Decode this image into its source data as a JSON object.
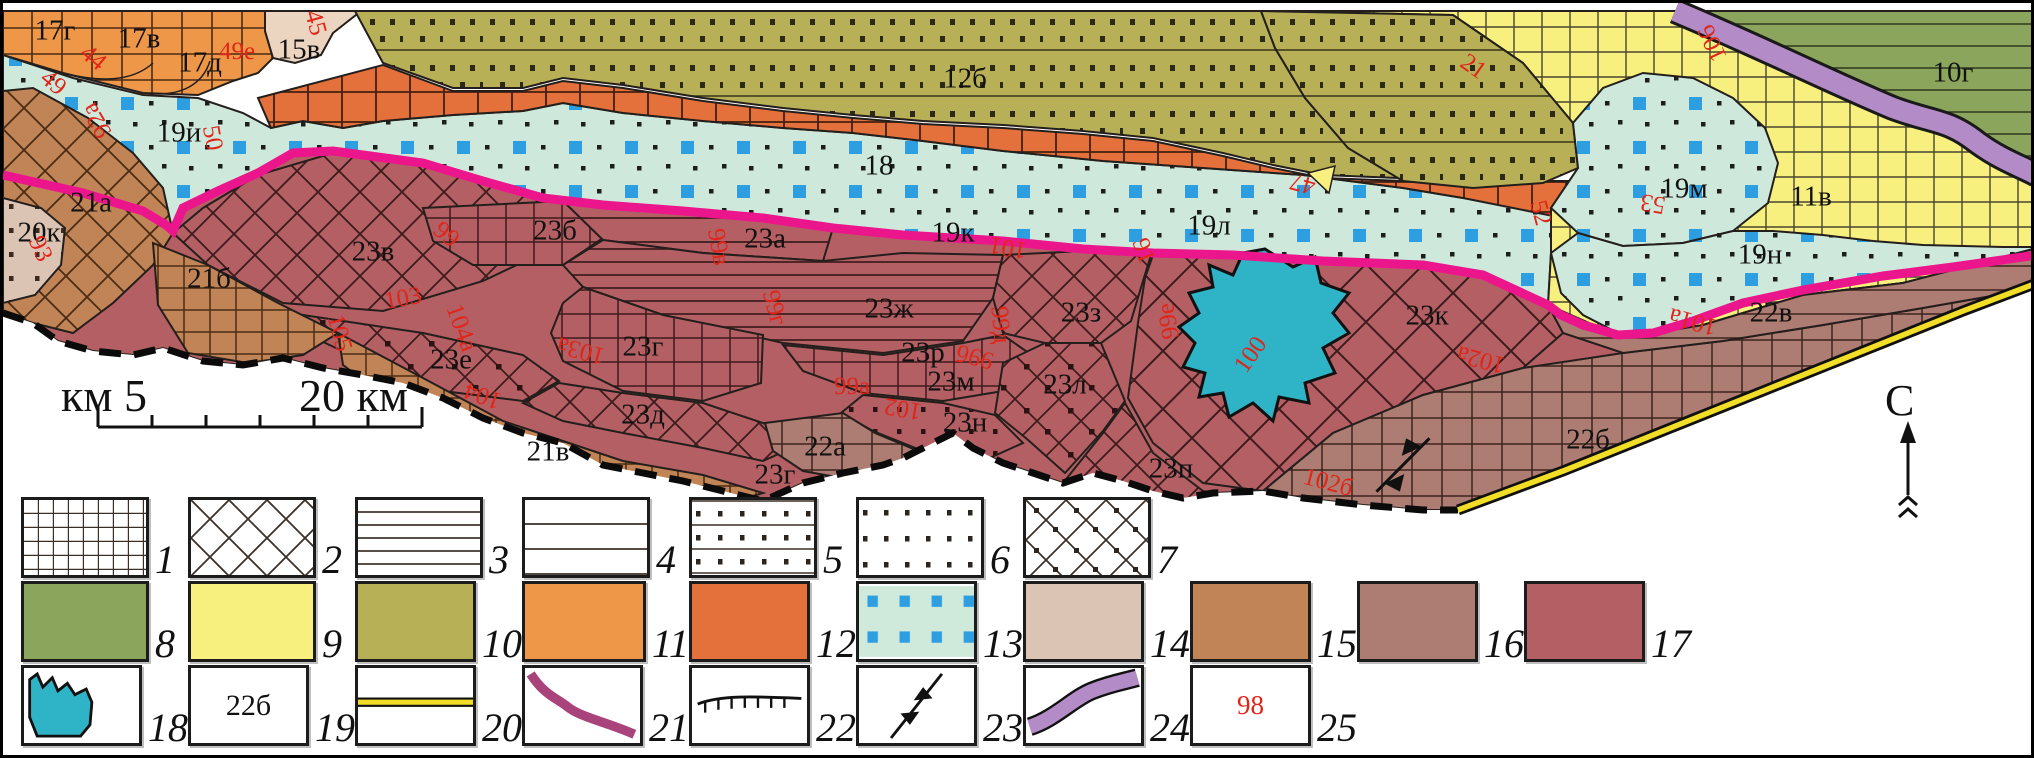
{
  "map": {
    "north_label": "С",
    "scale": {
      "left": "км 5",
      "right": "20 км"
    },
    "region_labels": [
      {
        "text": "17г",
        "x": 52,
        "y": 28
      },
      {
        "text": "17в",
        "x": 136,
        "y": 36
      },
      {
        "text": "17д",
        "x": 197,
        "y": 60
      },
      {
        "text": "15в",
        "x": 296,
        "y": 47
      },
      {
        "text": "19и",
        "x": 176,
        "y": 130
      },
      {
        "text": "21а",
        "x": 88,
        "y": 200
      },
      {
        "text": "20к",
        "x": 36,
        "y": 230
      },
      {
        "text": "21б",
        "x": 206,
        "y": 276
      },
      {
        "text": "23в",
        "x": 370,
        "y": 249
      },
      {
        "text": "23б",
        "x": 552,
        "y": 228
      },
      {
        "text": "23а",
        "x": 762,
        "y": 236
      },
      {
        "text": "18",
        "x": 876,
        "y": 163
      },
      {
        "text": "12б",
        "x": 962,
        "y": 76
      },
      {
        "text": "19к",
        "x": 950,
        "y": 230
      },
      {
        "text": "19л",
        "x": 1206,
        "y": 223
      },
      {
        "text": "19м",
        "x": 1681,
        "y": 186
      },
      {
        "text": "11в",
        "x": 1808,
        "y": 194
      },
      {
        "text": "10г",
        "x": 1950,
        "y": 70
      },
      {
        "text": "19н",
        "x": 1757,
        "y": 252
      },
      {
        "text": "23ж",
        "x": 886,
        "y": 306
      },
      {
        "text": "23з",
        "x": 1078,
        "y": 310
      },
      {
        "text": "23к",
        "x": 1424,
        "y": 313
      },
      {
        "text": "23г",
        "x": 640,
        "y": 344
      },
      {
        "text": "23е",
        "x": 448,
        "y": 357
      },
      {
        "text": "23д",
        "x": 640,
        "y": 412
      },
      {
        "text": "21в",
        "x": 545,
        "y": 449
      },
      {
        "text": "22а",
        "x": 822,
        "y": 444
      },
      {
        "text": "23н",
        "x": 962,
        "y": 420
      },
      {
        "text": "23м",
        "x": 948,
        "y": 379
      },
      {
        "text": "23л",
        "x": 1062,
        "y": 382
      },
      {
        "text": "23п",
        "x": 1168,
        "y": 466
      },
      {
        "text": "23р",
        "x": 920,
        "y": 350
      },
      {
        "text": "23г",
        "x": 772,
        "y": 472
      },
      {
        "text": "22б",
        "x": 1585,
        "y": 437
      },
      {
        "text": "22в",
        "x": 1768,
        "y": 310
      }
    ],
    "red_labels": [
      {
        "text": "44",
        "x": 90,
        "y": 55,
        "rot": 40
      },
      {
        "text": "49",
        "x": 50,
        "y": 80,
        "rot": 40
      },
      {
        "text": "49е",
        "x": 234,
        "y": 49,
        "rot": 0
      },
      {
        "text": "45",
        "x": 312,
        "y": 20,
        "rot": 75
      },
      {
        "text": "92а",
        "x": 94,
        "y": 117,
        "rot": 240
      },
      {
        "text": "50",
        "x": 209,
        "y": 135,
        "rot": 80
      },
      {
        "text": "93",
        "x": 37,
        "y": 246,
        "rot": 65
      },
      {
        "text": "105",
        "x": 336,
        "y": 330,
        "rot": 75
      },
      {
        "text": "103",
        "x": 400,
        "y": 296,
        "rot": -10
      },
      {
        "text": "104а",
        "x": 458,
        "y": 325,
        "rot": 70
      },
      {
        "text": "103а",
        "x": 578,
        "y": 347,
        "rot": 195
      },
      {
        "text": "104",
        "x": 480,
        "y": 392,
        "rot": 200
      },
      {
        "text": "99",
        "x": 443,
        "y": 232,
        "rot": 40
      },
      {
        "text": "99в",
        "x": 715,
        "y": 244,
        "rot": 80
      },
      {
        "text": "99г",
        "x": 771,
        "y": 305,
        "rot": 75
      },
      {
        "text": "99а",
        "x": 849,
        "y": 384,
        "rot": 0
      },
      {
        "text": "99б",
        "x": 972,
        "y": 353,
        "rot": 195
      },
      {
        "text": "99д",
        "x": 997,
        "y": 322,
        "rot": 85
      },
      {
        "text": "99е",
        "x": 1166,
        "y": 318,
        "rot": 260
      },
      {
        "text": "100",
        "x": 1248,
        "y": 352,
        "rot": -55
      },
      {
        "text": "101",
        "x": 1005,
        "y": 244,
        "rot": 190
      },
      {
        "text": "91",
        "x": 1140,
        "y": 248,
        "rot": 70
      },
      {
        "text": "102",
        "x": 900,
        "y": 405,
        "rot": 190
      },
      {
        "text": "102а",
        "x": 1478,
        "y": 356,
        "rot": 195
      },
      {
        "text": "102б",
        "x": 1325,
        "y": 480,
        "rot": 15
      },
      {
        "text": "101а",
        "x": 1690,
        "y": 318,
        "rot": 195
      },
      {
        "text": "47",
        "x": 1300,
        "y": 180,
        "rot": 195
      },
      {
        "text": "21",
        "x": 1470,
        "y": 64,
        "rot": 35
      },
      {
        "text": "106",
        "x": 1710,
        "y": 40,
        "rot": 245
      },
      {
        "text": "53",
        "x": 1650,
        "y": 200,
        "rot": 190
      },
      {
        "text": "52",
        "x": 1537,
        "y": 210,
        "rot": 75
      }
    ]
  },
  "legend": {
    "items": [
      {
        "num": "1"
      },
      {
        "num": "2"
      },
      {
        "num": "3"
      },
      {
        "num": "4"
      },
      {
        "num": "5"
      },
      {
        "num": "6"
      },
      {
        "num": "7"
      },
      {
        "num": "8"
      },
      {
        "num": "9"
      },
      {
        "num": "10"
      },
      {
        "num": "11"
      },
      {
        "num": "12"
      },
      {
        "num": "13"
      },
      {
        "num": "14"
      },
      {
        "num": "15"
      },
      {
        "num": "16"
      },
      {
        "num": "17"
      },
      {
        "num": "18"
      },
      {
        "num": "19",
        "sample_text": "22б"
      },
      {
        "num": "20"
      },
      {
        "num": "21"
      },
      {
        "num": "22"
      },
      {
        "num": "23"
      },
      {
        "num": "24"
      },
      {
        "num": "25",
        "sample_text": "98"
      }
    ]
  },
  "colors": {
    "green_10": "#8BA55C",
    "yellow_11": "#F7F07E",
    "olive_12": "#B8B057",
    "orange_light_17": "#EF9748",
    "orange_dark_18": "#E4703B",
    "teal_19": "#CEE9DB",
    "teal_squares": "#2D9FE0",
    "pale_20": "#DBC4B4",
    "brown_21": "#C08456",
    "mauve_22": "#AD7C72",
    "maroon_23": "#B45F63",
    "lake": "#2FB4C7",
    "magenta_line": "#EC168C",
    "legend_line_21": "#A8437C",
    "lilac_band": "#B38BC7",
    "yellow_line": "#F2DE26",
    "red_label": "#E02519"
  }
}
